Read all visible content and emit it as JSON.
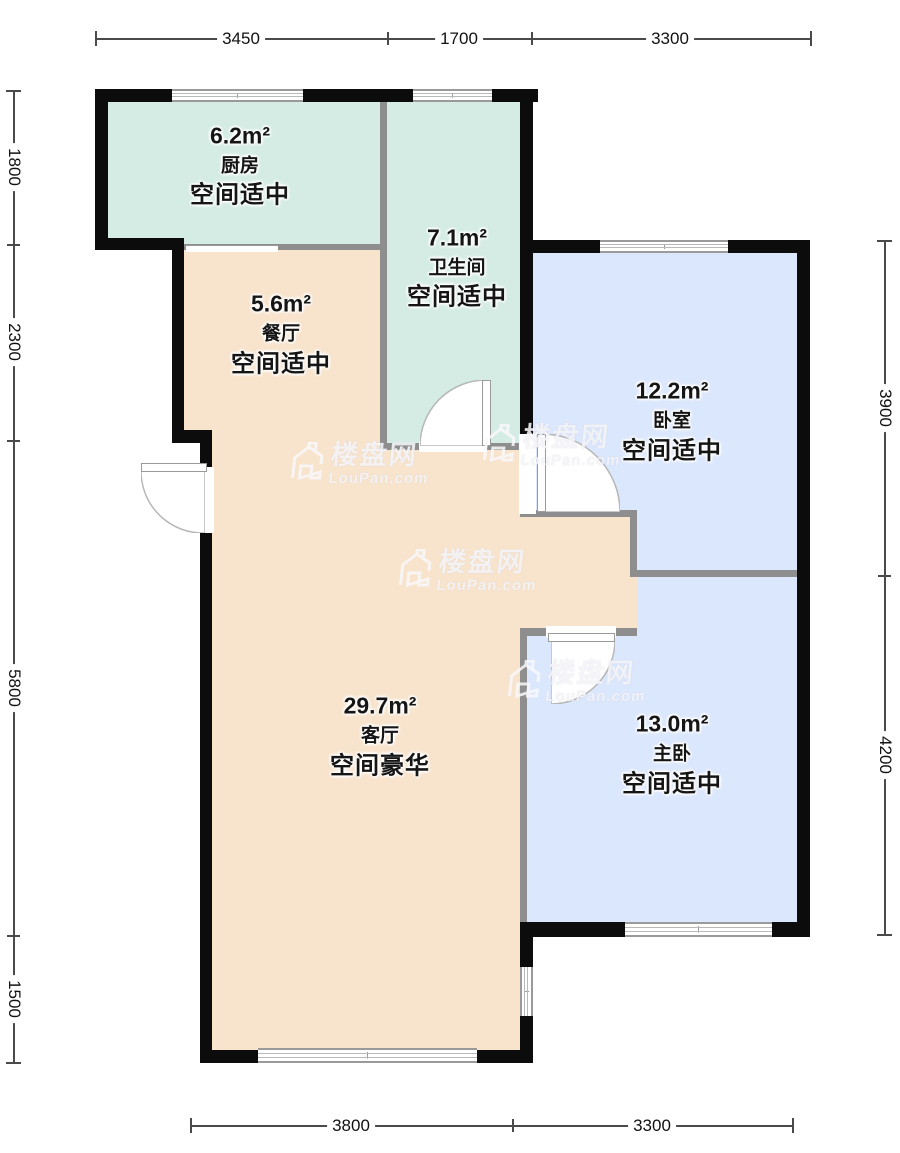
{
  "rooms": [
    {
      "id": "kitchen",
      "area": "6.2m²",
      "name": "厨房",
      "status": "空间适中"
    },
    {
      "id": "bathroom",
      "area": "7.1m²",
      "name": "卫生间",
      "status": "空间适中"
    },
    {
      "id": "dining",
      "area": "5.6m²",
      "name": "餐厅",
      "status": "空间适中"
    },
    {
      "id": "bedroom",
      "area": "12.2m²",
      "name": "卧室",
      "status": "空间适中"
    },
    {
      "id": "living",
      "area": "29.7m²",
      "name": "客厅",
      "status": "空间豪华"
    },
    {
      "id": "master-bedroom",
      "area": "13.0m²",
      "name": "主卧",
      "status": "空间适中"
    }
  ],
  "dimensions": {
    "top": [
      "3450",
      "1700",
      "3300"
    ],
    "bottom": [
      "3800",
      "3300"
    ],
    "left": [
      "1800",
      "2300",
      "5800",
      "1500"
    ],
    "right": [
      "3900",
      "4200"
    ]
  },
  "watermark": {
    "brand": "楼盘网",
    "domain": "LouPan.com"
  },
  "colors": {
    "kitchen_bathroom_fill": "#d4ece4",
    "dining_living_fill": "#f8e4cc",
    "bedroom_fill": "#dbe7fc",
    "exterior_wall": "#0c0c0c",
    "interior_wall": "#8e8e8e",
    "dimension_line": "#4a4a4a"
  }
}
